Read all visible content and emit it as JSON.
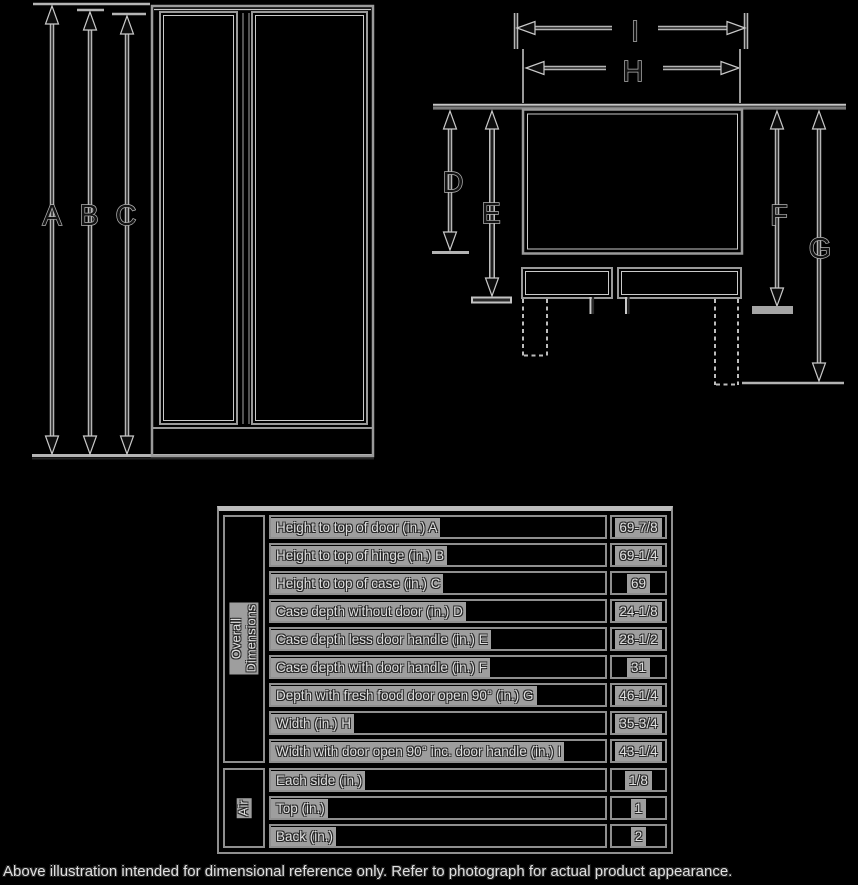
{
  "diagram": {
    "labels": {
      "A": "A",
      "B": "B",
      "C": "C",
      "D": "D",
      "E": "E",
      "F": "F",
      "G": "G",
      "H": "H",
      "I": "I"
    }
  },
  "table": {
    "sections": [
      {
        "group_label": "Overall Dimensions",
        "rows": [
          {
            "label": "Height to top of door (in.) A",
            "value": "69-7/8"
          },
          {
            "label": "Height to top of hinge (in.) B",
            "value": "69-1/4"
          },
          {
            "label": "Height to top of case (in.) C",
            "value": "69"
          },
          {
            "label": "Case depth without door (in.) D",
            "value": "24-1/8"
          },
          {
            "label": "Case depth less door handle (in.) E",
            "value": "28-1/2"
          },
          {
            "label": "Case depth with door handle (in.) F",
            "value": "31"
          },
          {
            "label": "Depth with fresh food door open 90° (in.) G",
            "value": "46-1/4"
          },
          {
            "label": "Width (in.) H",
            "value": "35-3/4"
          },
          {
            "label": "Width with door open 90° inc. door handle (in.) I",
            "value": "43-1/4"
          }
        ]
      },
      {
        "group_label": "Air",
        "rows": [
          {
            "label": "Each side (in.)",
            "value": "1/8"
          },
          {
            "label": "Top (in.)",
            "value": "1"
          },
          {
            "label": "Back (in.)",
            "value": "2"
          }
        ]
      }
    ]
  },
  "footer": {
    "note": "Above illustration intended for dimensional reference only. Refer to photograph for actual product appearance."
  },
  "colors": {
    "background": "#000000",
    "line": "#9a9a9a",
    "line_light": "#c9c9c9",
    "cell_background": "#9e9e9e",
    "table_border": "#8f8f8f"
  }
}
